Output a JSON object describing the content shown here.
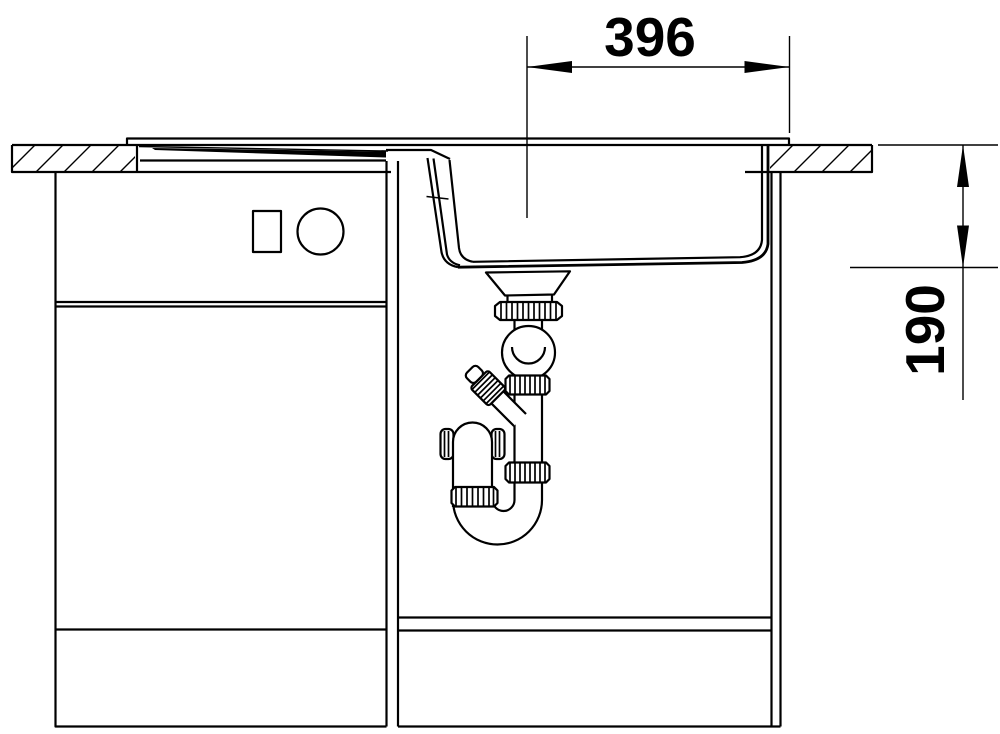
{
  "drawing": {
    "dimensions": {
      "top_width_label": "396",
      "right_depth_label": "190"
    },
    "colors": {
      "line": "#000000",
      "background": "#ffffff"
    }
  }
}
